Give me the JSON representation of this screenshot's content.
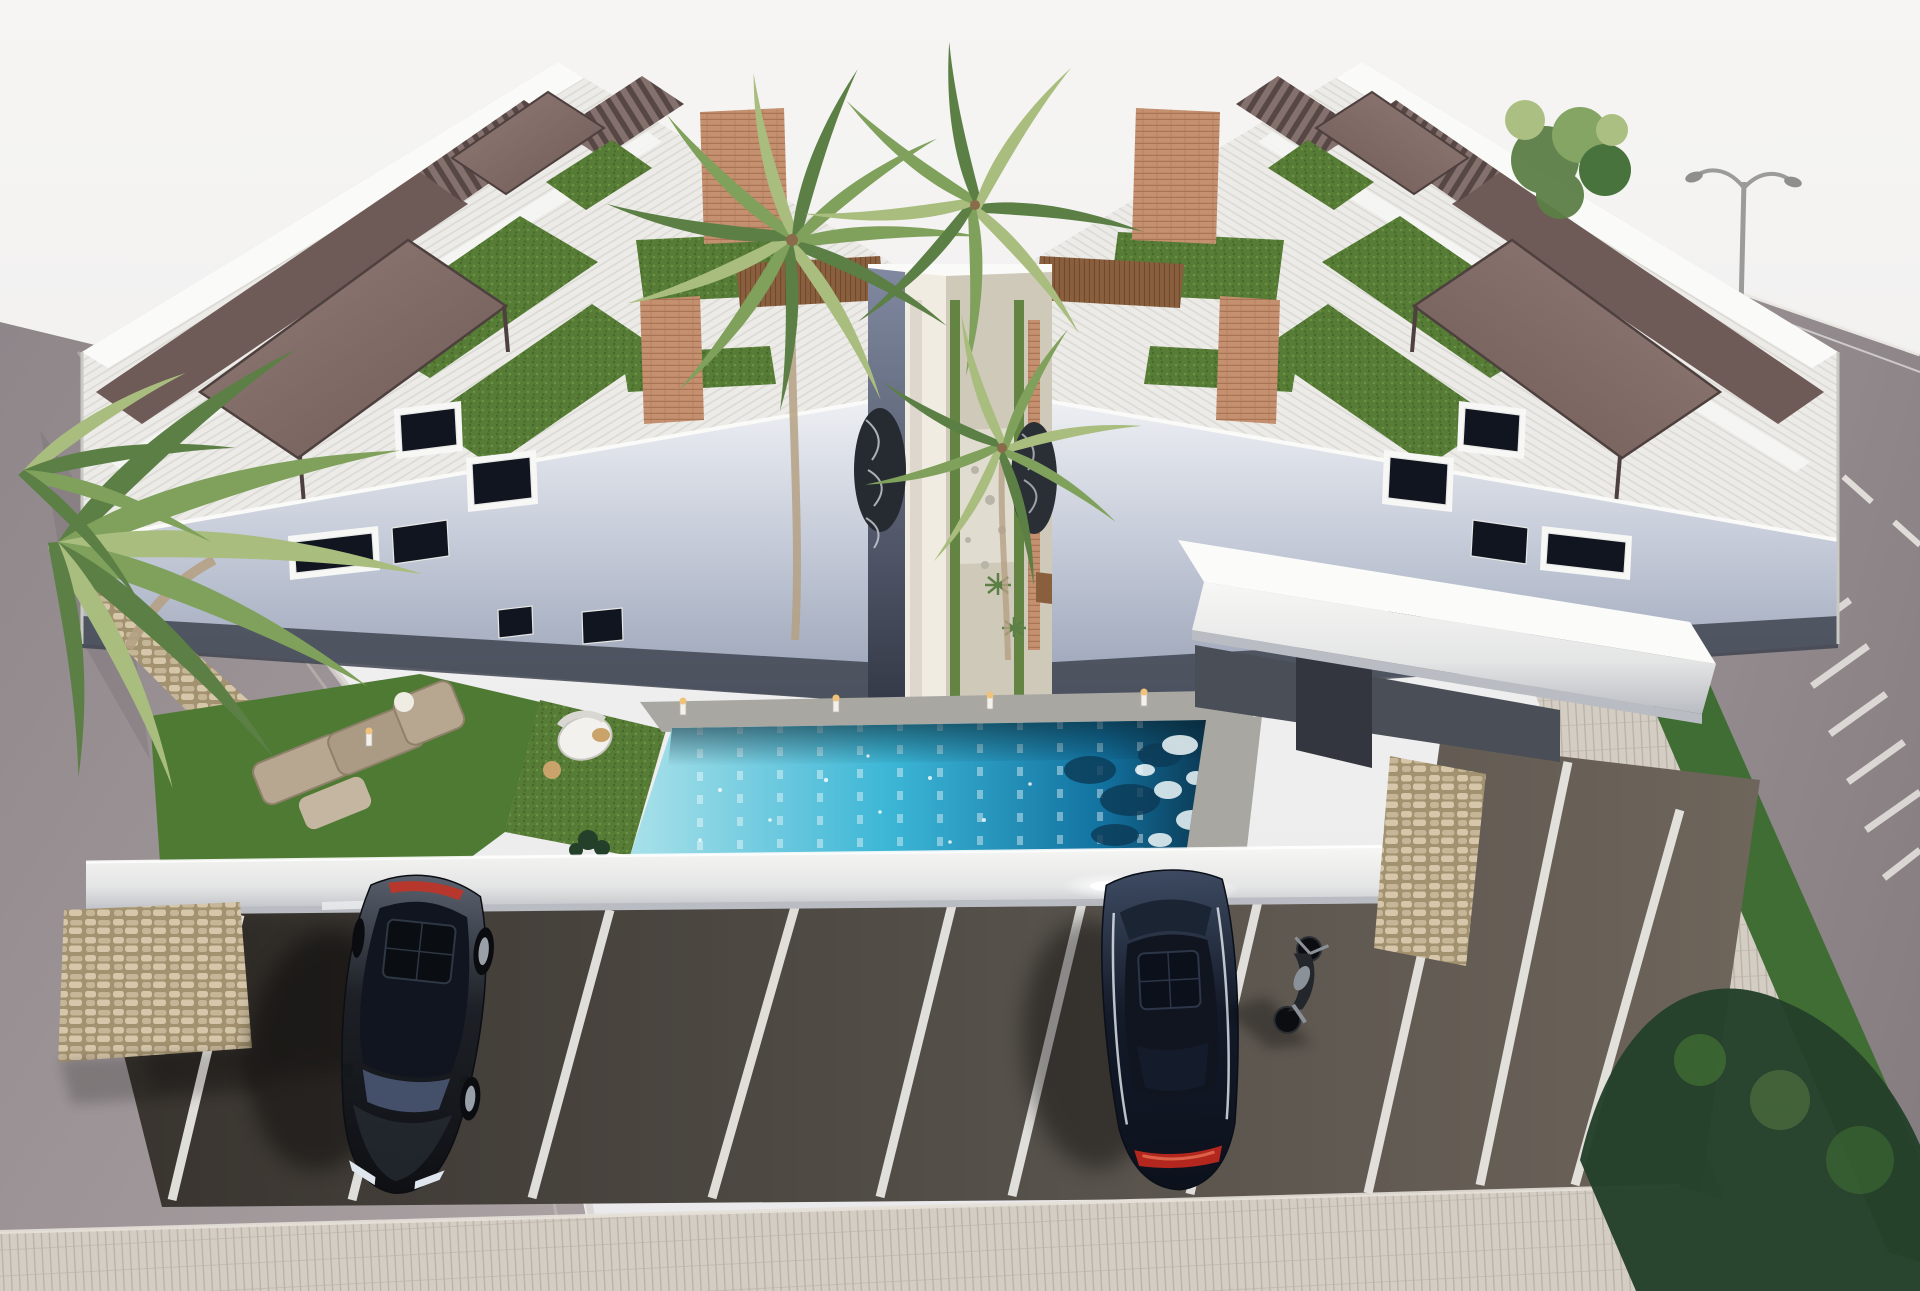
{
  "meta": {
    "title": "Aerial 3D render — twin white apartment buildings with rooftop pergolas, palm courtyard, elevated pool and parking",
    "description": "Architectural visualization: two mirrored modern white residential blocks, rooftop terraces with bronze pergolas and artificial turf, central palm-lined walkway, elevated deck with long turquoise pool, front parking lot with two dark cars and a motorcycle, streets on both sides and a paver sidewalk in the foreground."
  },
  "scene": {
    "sky_label": "pale overcast sky",
    "building_left_label": "left apartment building",
    "building_right_label": "right apartment building",
    "courtyard_label": "central palm courtyard walkway",
    "pool_label": "elevated turquoise lap pool",
    "garden_label": "front garden with outdoor sofa and round lounger",
    "parking_label": "parking lot",
    "road_left_label": "street on the left",
    "road_right_label": "street on the right with lane markings",
    "lamp_label": "double-arm street lamp",
    "sidewalk_label": "paver sidewalk",
    "parking_stall_line_count": 10,
    "vehicle_counts": {
      "cars": 2,
      "motorcycles": 1
    }
  },
  "colors": {
    "sky_top": "#f6f5f3",
    "sky_bottom": "#e9e9ec",
    "parapet": "#fafaf8",
    "wall_light": "#f0efec",
    "terrace_base": "#ecebe7",
    "stripe": "#dbdad5",
    "facade_top": "#edeff3",
    "facade_mid": "#c6ccd9",
    "facade_low": "#97a0b5",
    "plinth": "#3f4450",
    "pergola_a": "#937c77",
    "pergola_b": "#6e5a56",
    "pergola_edge": "#4e403e",
    "louvre_a": "#84706c",
    "louvre_b": "#564745",
    "turf_a": "#567c36",
    "turf_b": "#47682c",
    "turf_dot": "#6b9344",
    "lawn": "#4f7a33",
    "brick_a": "#c4906f",
    "brick_b": "#a87454",
    "wood_a": "#8a5f3e",
    "wood_b": "#6f4a2e",
    "stone_a": "#c6b698",
    "stone_b": "#d6c7ab",
    "stone_c": "#a3926f",
    "gap_top": "#8089a0",
    "gap_bottom": "#343947",
    "warm_wall": "#f1ece2",
    "gravel": "#cfc9ba",
    "gravel_light": "#e3dfd4",
    "deck": "#a8a7a2",
    "deck_dark": "#8f8e8a",
    "pool_shallow": "#a9e1e9",
    "pool_mid": "#3cb6d6",
    "pool_deep": "#1272a0",
    "pool_ink": "#0c3a55",
    "foam": "#eef8f9",
    "fascia_top": "#f7f7f5",
    "fascia_mid": "#e4e5e5",
    "fascia_bottom": "#b9bcc2",
    "glow": "#ffffff",
    "asphalt_a": "#38332e",
    "asphalt_b": "#55504a",
    "asphalt_c": "#6e655b",
    "stall": "#e9e7e3",
    "paver": "#d3cdc3",
    "paver_line": "#b7b1a6",
    "road_left_a": "#8e8689",
    "road_left_b": "#aaa2a3",
    "curb": "#d8d4d0",
    "road_right_a": "#9a9294",
    "road_right_b": "#837b7e",
    "road_mark": "#f0eeea",
    "hedge": "#3f6d33",
    "foliage": "#24402a",
    "palm_a": "#7fa15c",
    "palm_b": "#5c7f46",
    "palm_c": "#a9bd7e",
    "trunk": "#b5a184",
    "coconut": "#8a6b4a",
    "car1_hi": "#59616e",
    "car1_mid": "#1d2026",
    "car1_dark": "#0e1014",
    "car2_hi": "#3d4a61",
    "car2_mid": "#131a28",
    "car2_dark": "#0c111c",
    "glass": "#101520",
    "glass_hi": "#44506a",
    "tail": "#c23327",
    "rim": "#9aa0a8",
    "lamp": "#9b9b99",
    "metal": "#8b9199",
    "moto_dark": "#23262b",
    "warm_light": "#f0c27a"
  }
}
